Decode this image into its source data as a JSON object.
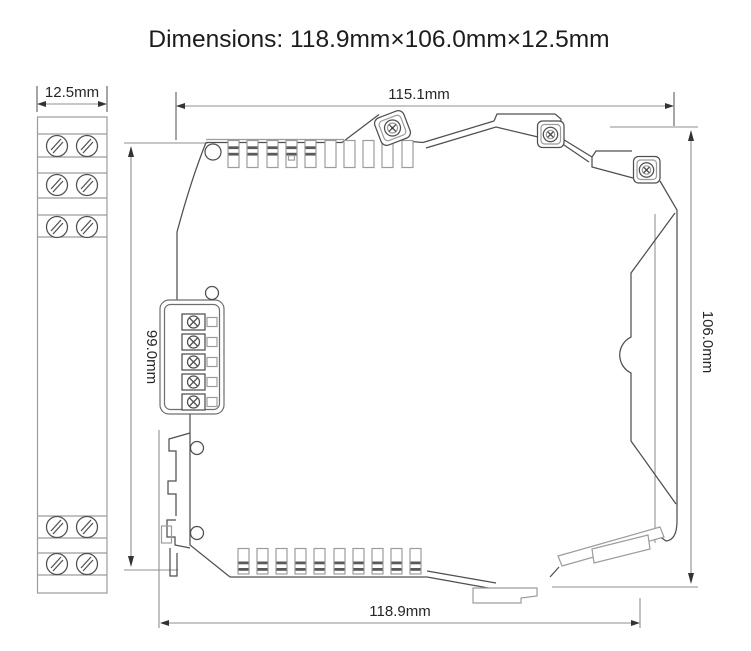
{
  "title": "Dimensions: 118.9mm×106.0mm×12.5mm",
  "views": {
    "front": {
      "name": "front view (DIN module end face)",
      "width_dim": "12.5mm"
    },
    "side": {
      "name": "side view (DIN module profile)",
      "top_width_dim": "115.1mm",
      "bottom_width_dim": "118.9mm",
      "overall_height_dim": "106.0mm",
      "body_height_dim": "99.0mm"
    }
  },
  "colors": {
    "background": "#ffffff",
    "line_dark": "#4f4f4f",
    "line_gray": "#9c9c9c",
    "dimension_line": "#8f8f8f",
    "text": "#1c1c1c"
  }
}
